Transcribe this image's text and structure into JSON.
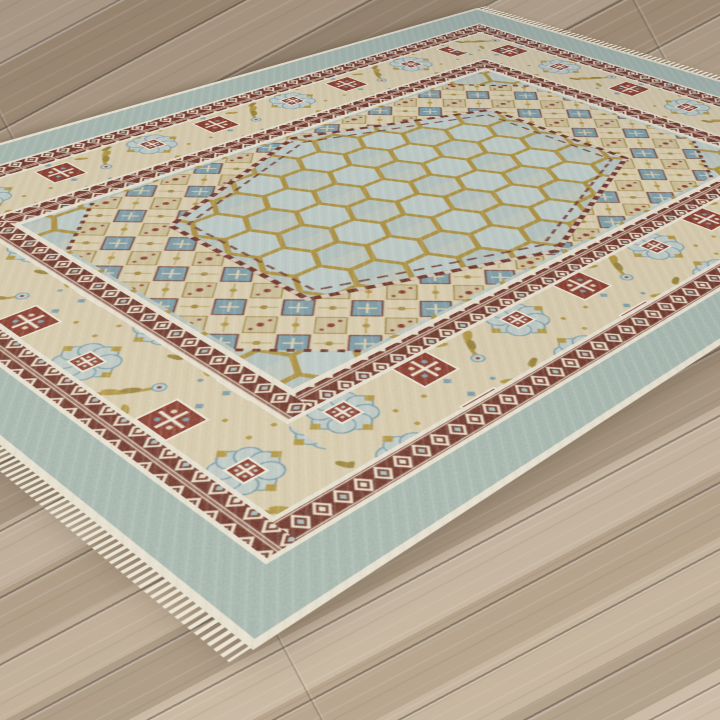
{
  "meta": {
    "type": "product-photo",
    "subject": "Traditional oriental area rug shown at an angle on a light oak plank floor",
    "alt": "Light blue and beige oriental rug with a gold honeycomb lattice field, stepped diamond medallion band, maroon triangle guard borders and a floral main border, lying diagonally on wood flooring"
  },
  "floor": {
    "label": "light oak wood plank floor",
    "plank_base": "#b2a08b",
    "plank_light": "#c4b29a",
    "plank_dark": "#9c8a75",
    "gap_color": "#3e322880"
  },
  "rug": {
    "label": "oriental area rug",
    "fringe": "#ece5d3",
    "edge_cream": "#e7e0cf",
    "outer_band_blue": "#9db1a9",
    "guard_cream": "#e7e0cf",
    "minor_border_maroon": "#5e1d12",
    "minor_border_motif": "#e6dcc4",
    "minor_border_accent": "#9fb6b4",
    "main_border_ground": "#d5c7a6",
    "main_border_gold": "#a98a2e",
    "main_border_gold_dark": "#8f7526",
    "main_border_blue": "#6f93a0",
    "main_border_pale_blue": "#b9c6c2",
    "main_border_red": "#7c2416",
    "field_blue": "#b3c3c0",
    "lattice_gold": "#a5862d",
    "band_ground": "#d8caa9",
    "band_blue": "#6f93a0",
    "band_tan": "#b0935a",
    "zigzag_maroon": "#5e1d12",
    "pattern_names": [
      "honeycomb lattice field",
      "stepped lozenge medallion band",
      "latch-hook triangle guard borders",
      "rosette and palmette floral main border"
    ]
  }
}
